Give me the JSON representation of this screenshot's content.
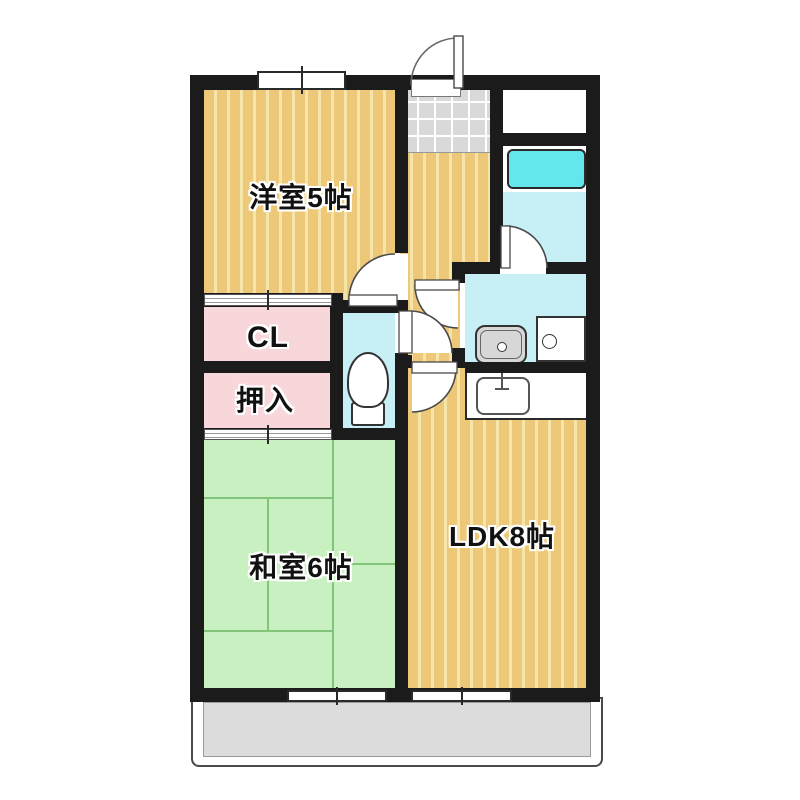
{
  "plan": {
    "type": "apartment-floor-plan",
    "rooms": {
      "western_room": {
        "label": "洋室5帖"
      },
      "closet": {
        "label": "CL"
      },
      "oshiire": {
        "label": "押入"
      },
      "japanese_room": {
        "label": "和室6帖"
      },
      "ldk": {
        "label": "LDK8帖"
      }
    },
    "fixtures": [
      "entrance-door",
      "genkan-tile",
      "bathtub",
      "bath-door",
      "washbasin",
      "washing-machine-pan",
      "toilet",
      "toilet-door",
      "kitchen-sink",
      "western-room-door",
      "washroom-door",
      "ldk-door",
      "closet-sliding-door",
      "oshiire-sliding-door",
      "window-top",
      "window-japanese-room",
      "window-ldk",
      "balcony"
    ],
    "colors": {
      "wall": "#1b1b1b",
      "wood_floor": "#ecc878",
      "wood_stripe": "#f6e5a8",
      "tatami_green": "#c9f0c0",
      "closet_pink": "#f8d7da",
      "water_cyan": "#c6f0f5",
      "bathtub_cyan": "#63e7ec",
      "tile_gray": "#d9d9d9",
      "balcony_gray": "#dcdcdc"
    }
  }
}
